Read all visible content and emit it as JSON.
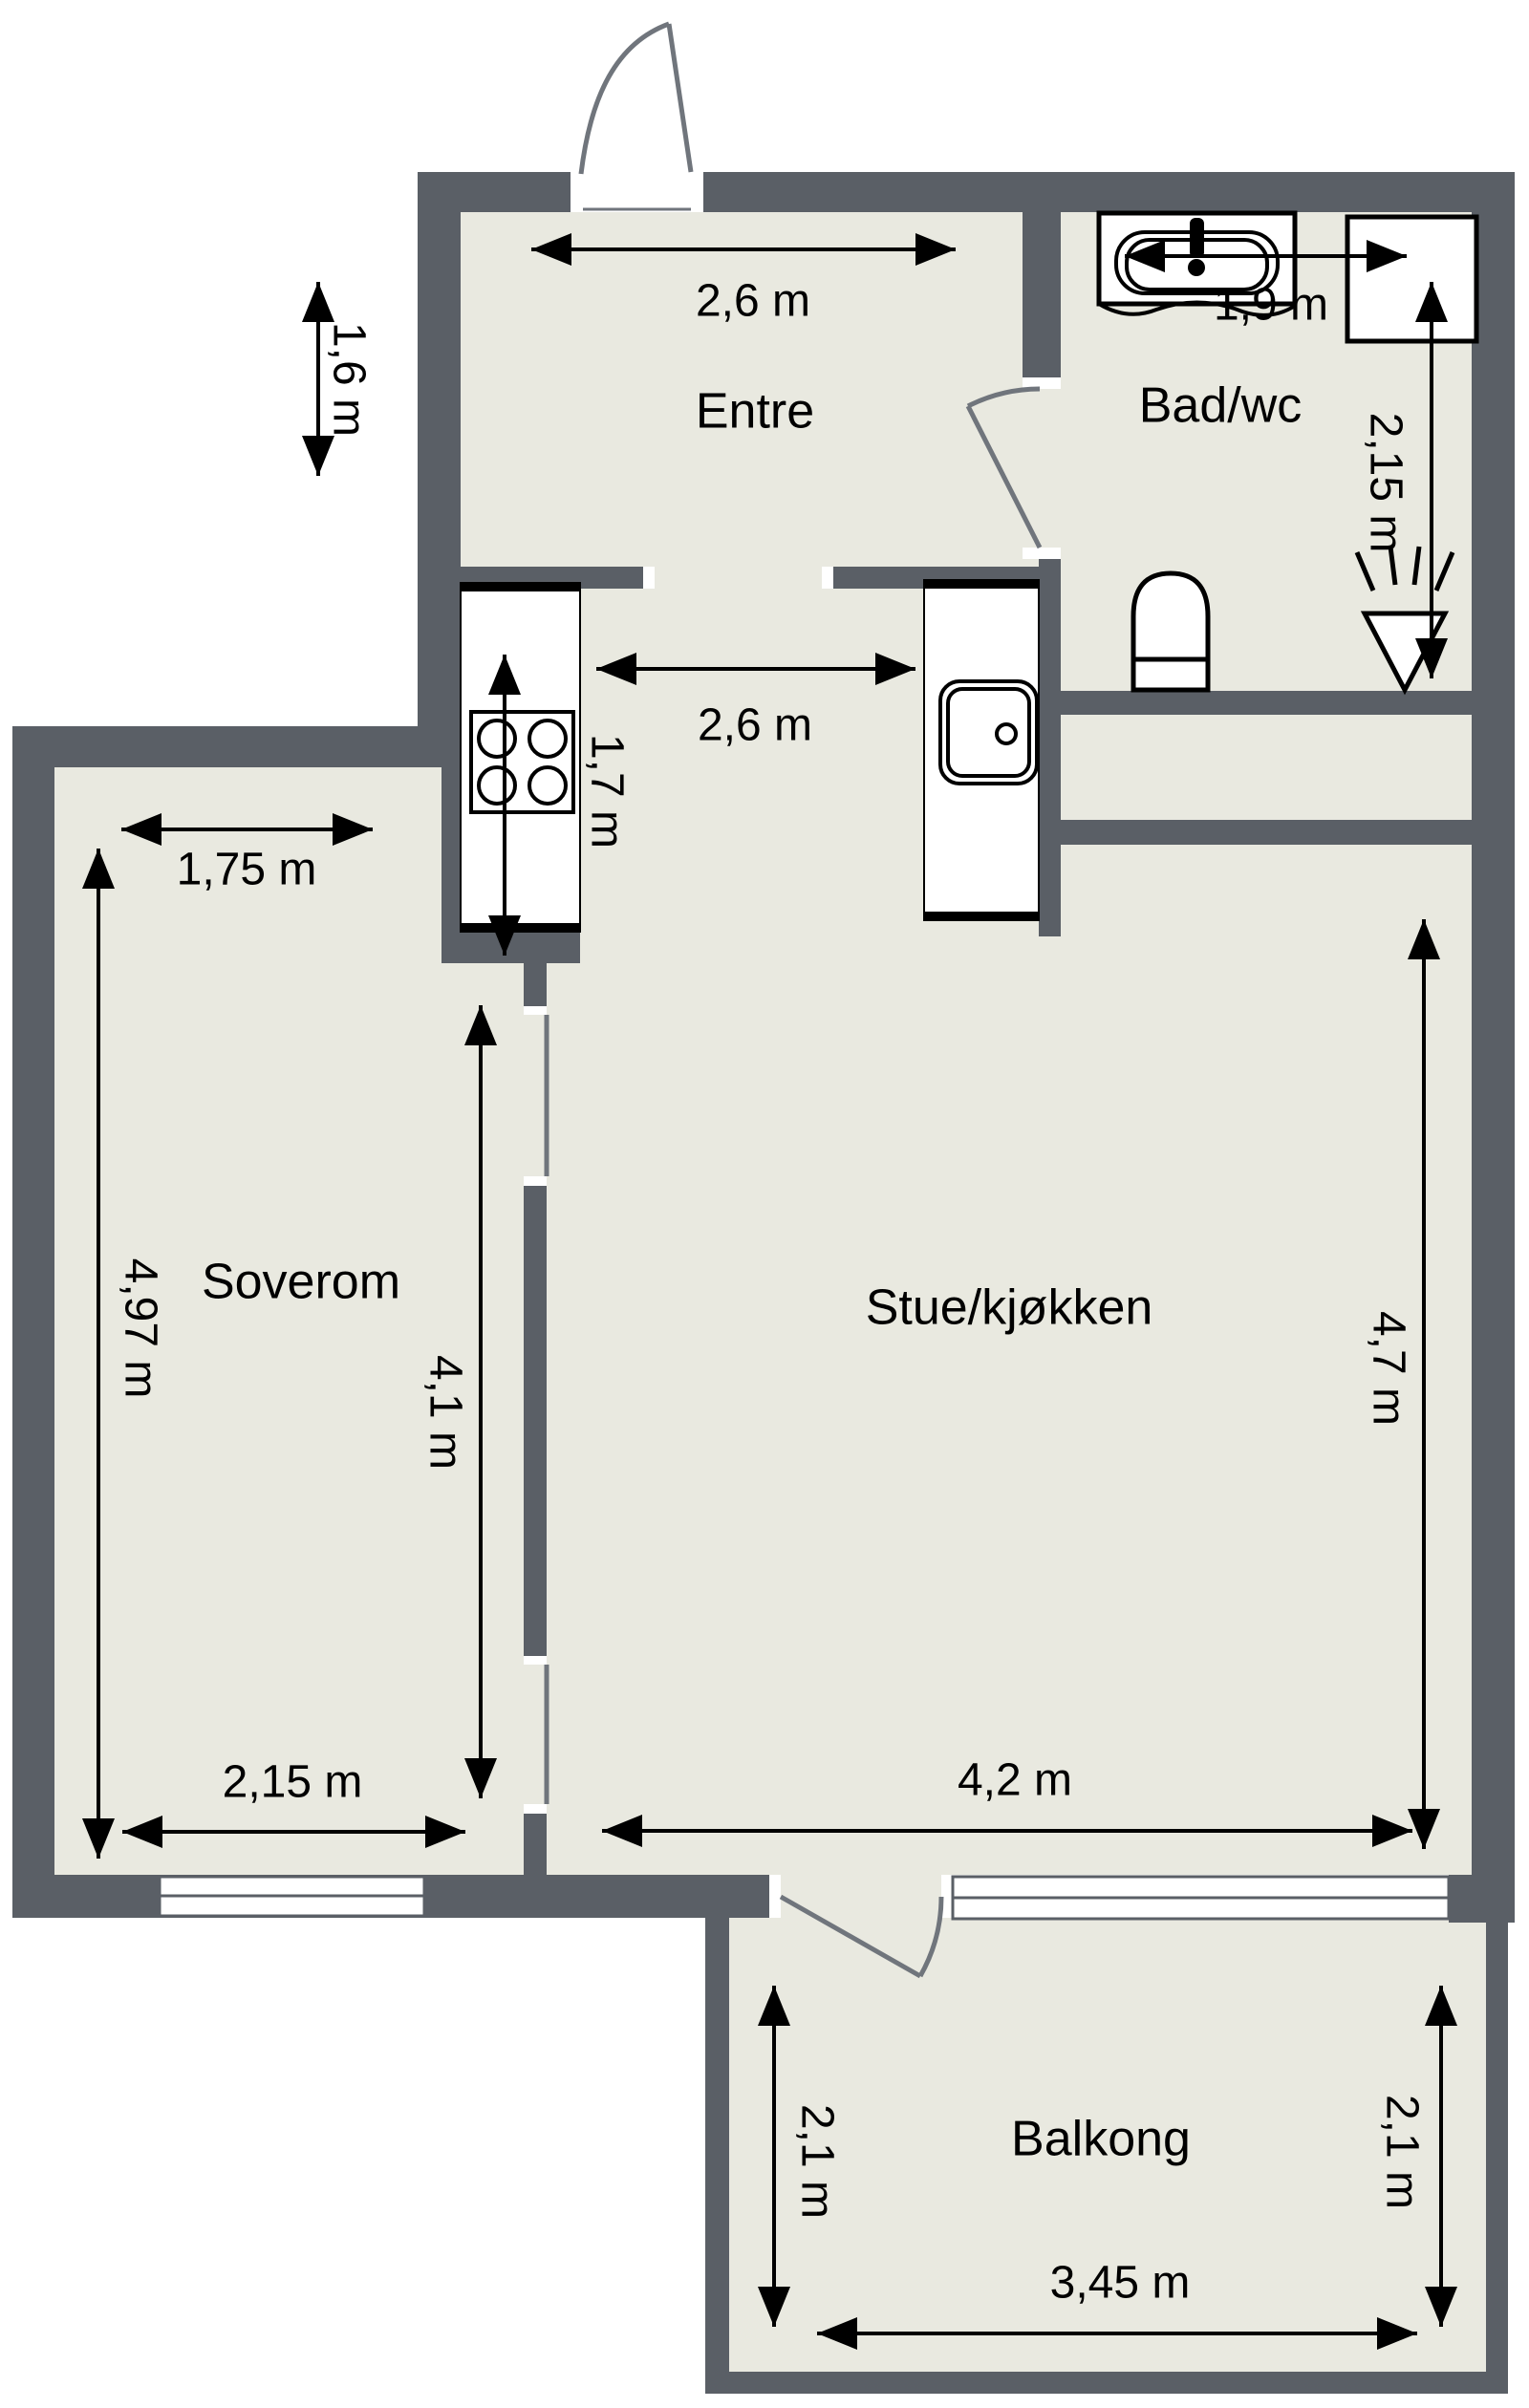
{
  "title": "Floor plan",
  "colors": {
    "wall": "#5a5f66",
    "floor": "#e9e9e0",
    "ink": "#000000"
  },
  "rooms": {
    "entre": {
      "label": "Entre",
      "width_label": "2,6 m",
      "height_label": "1,6 m"
    },
    "bad": {
      "label": "Bad/wc",
      "width_label": "1,9 m",
      "height_label": "2,15 m"
    },
    "kitchen": {
      "width_label": "2,6 m",
      "counter_label": "1,7 m"
    },
    "soverom": {
      "label": "Soverom",
      "top_width_label": "1,75 m",
      "left_height_label": "4,97 m",
      "bottom_width_label": "2,15 m",
      "inner_height_label": "4,1 m"
    },
    "stue": {
      "label": "Stue/kjøkken",
      "height_label": "4,7 m",
      "width_label": "4,2 m"
    },
    "balkong": {
      "label": "Balkong",
      "left_height_label": "2,1 m",
      "right_height_label": "2,1 m",
      "width_label": "3,45 m"
    }
  }
}
